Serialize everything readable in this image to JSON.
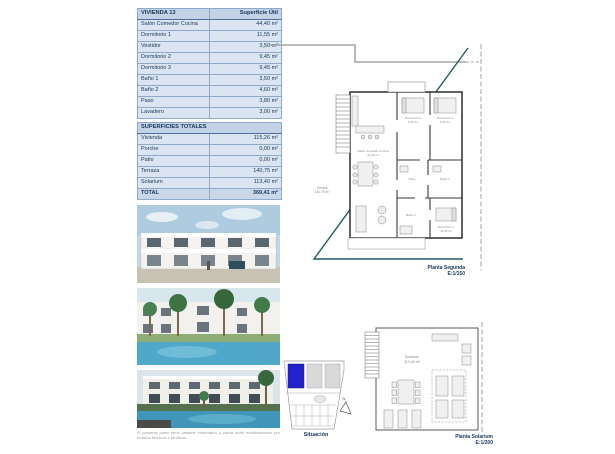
{
  "table_vivienda": {
    "title": "VIVIENDA 13",
    "header_value": "Superficie Útil",
    "rows": [
      {
        "label": "Salón Comedor Cocina",
        "value": "44,40 m²"
      },
      {
        "label": "Dormitorio 1",
        "value": "11,55 m²"
      },
      {
        "label": "Vestidor",
        "value": "3,50 m²"
      },
      {
        "label": "Dormitorio 2",
        "value": "9,45 m²"
      },
      {
        "label": "Dormitorio 3",
        "value": "9,45 m²"
      },
      {
        "label": "Baño 1",
        "value": "3,50 m²"
      },
      {
        "label": "Baño 2",
        "value": "4,60 m²"
      },
      {
        "label": "Paso",
        "value": "3,80 m²"
      },
      {
        "label": "Lavadero",
        "value": "3,00 m²"
      }
    ]
  },
  "table_totales": {
    "title": "SUPERFICIES TOTALES",
    "rows": [
      {
        "label": "Vivienda",
        "value": "115,26 m²"
      },
      {
        "label": "Porche",
        "value": "0,00 m²"
      },
      {
        "label": "Patio",
        "value": "0,00 m²"
      },
      {
        "label": "Terraza",
        "value": "140,75 m²"
      },
      {
        "label": "Solarium",
        "value": "113,40 m²"
      }
    ],
    "total_label": "TOTAL",
    "total_value": "369,41 m²"
  },
  "plan_segunda": {
    "caption_line1": "Planta Segunda",
    "caption_line2": "E:1/150",
    "rooms": {
      "salon": "Salón Comedor Cocina",
      "salon_area": "44,40 m²",
      "dorm2": "Dormitorio 2",
      "dorm2_area": "9,45 m²",
      "dorm3": "Dormitorio 3",
      "dorm3_area": "9,45 m²",
      "dorm1": "Dormitorio 1",
      "dorm1_area": "11,55 m²",
      "paso": "Paso",
      "bano1": "Baño 1",
      "bano2": "Baño 2",
      "terraza": "Terraza",
      "terraza_area": "140,75 m²"
    }
  },
  "plan_solarium": {
    "caption_line1": "Planta Solarium",
    "caption_line2": "E:1/200",
    "label_line1": "Solarium",
    "label_line2": "113,40 m²"
  },
  "situacion": {
    "caption": "Situación",
    "north_letter": "N"
  },
  "disclaimer": "El presente plano tiene carácter informativo y puede sufrir modificaciones por motivos técnicos o jurídicos.",
  "colors": {
    "text_navy": "#17365d",
    "table_row_bg": "#dbe5f1",
    "table_header_bg": "#c3d2e6",
    "table_border": "#8ea9c9",
    "terrace_line": "#235b66",
    "situacion_highlight": "#2222cc",
    "pool_blue": "#4fa8c9"
  }
}
